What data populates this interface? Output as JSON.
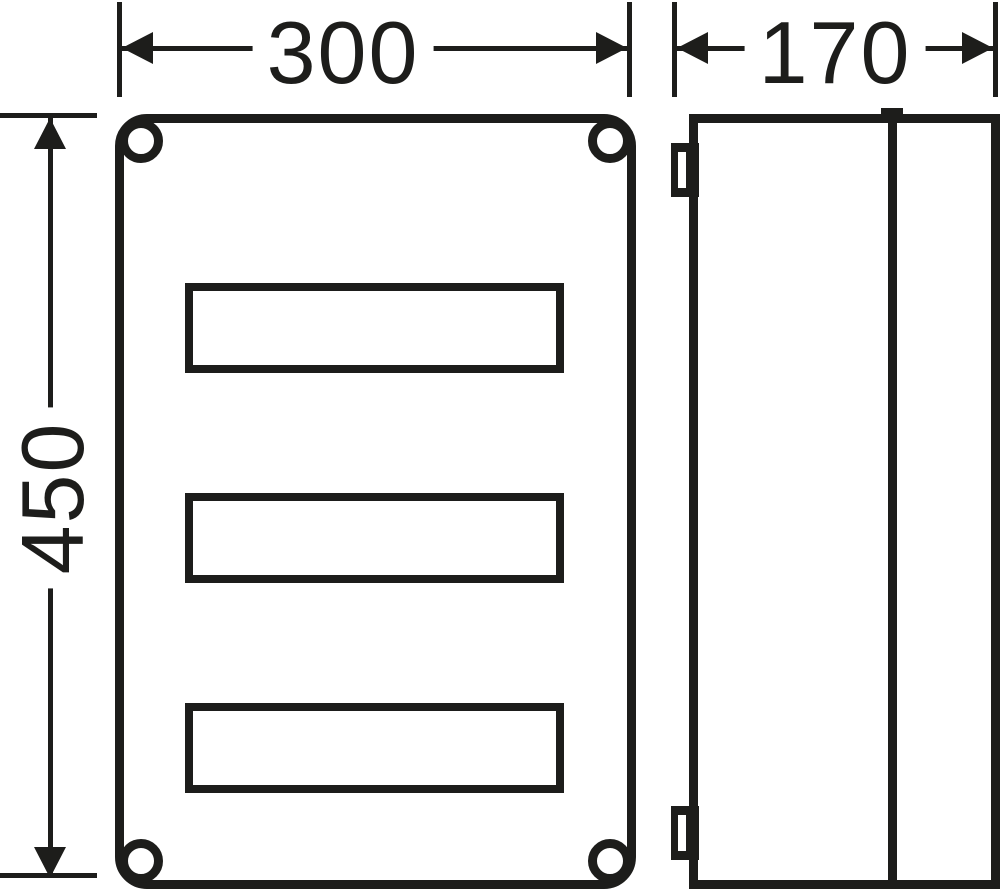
{
  "drawing": {
    "type": "dimensioned technical drawing of an electrical enclosure",
    "colors": {
      "line": "#1d1d1b",
      "background": "#ffffff"
    },
    "dimensions": {
      "width": {
        "label": "300"
      },
      "depth": {
        "label": "170"
      },
      "height": {
        "label": "450"
      }
    },
    "views": {
      "front": {
        "din_rail_cutouts": 3,
        "corner_screw_holes": 4
      },
      "side": {
        "wall_tabs": 2,
        "cover_seam_lines": 1
      }
    }
  }
}
